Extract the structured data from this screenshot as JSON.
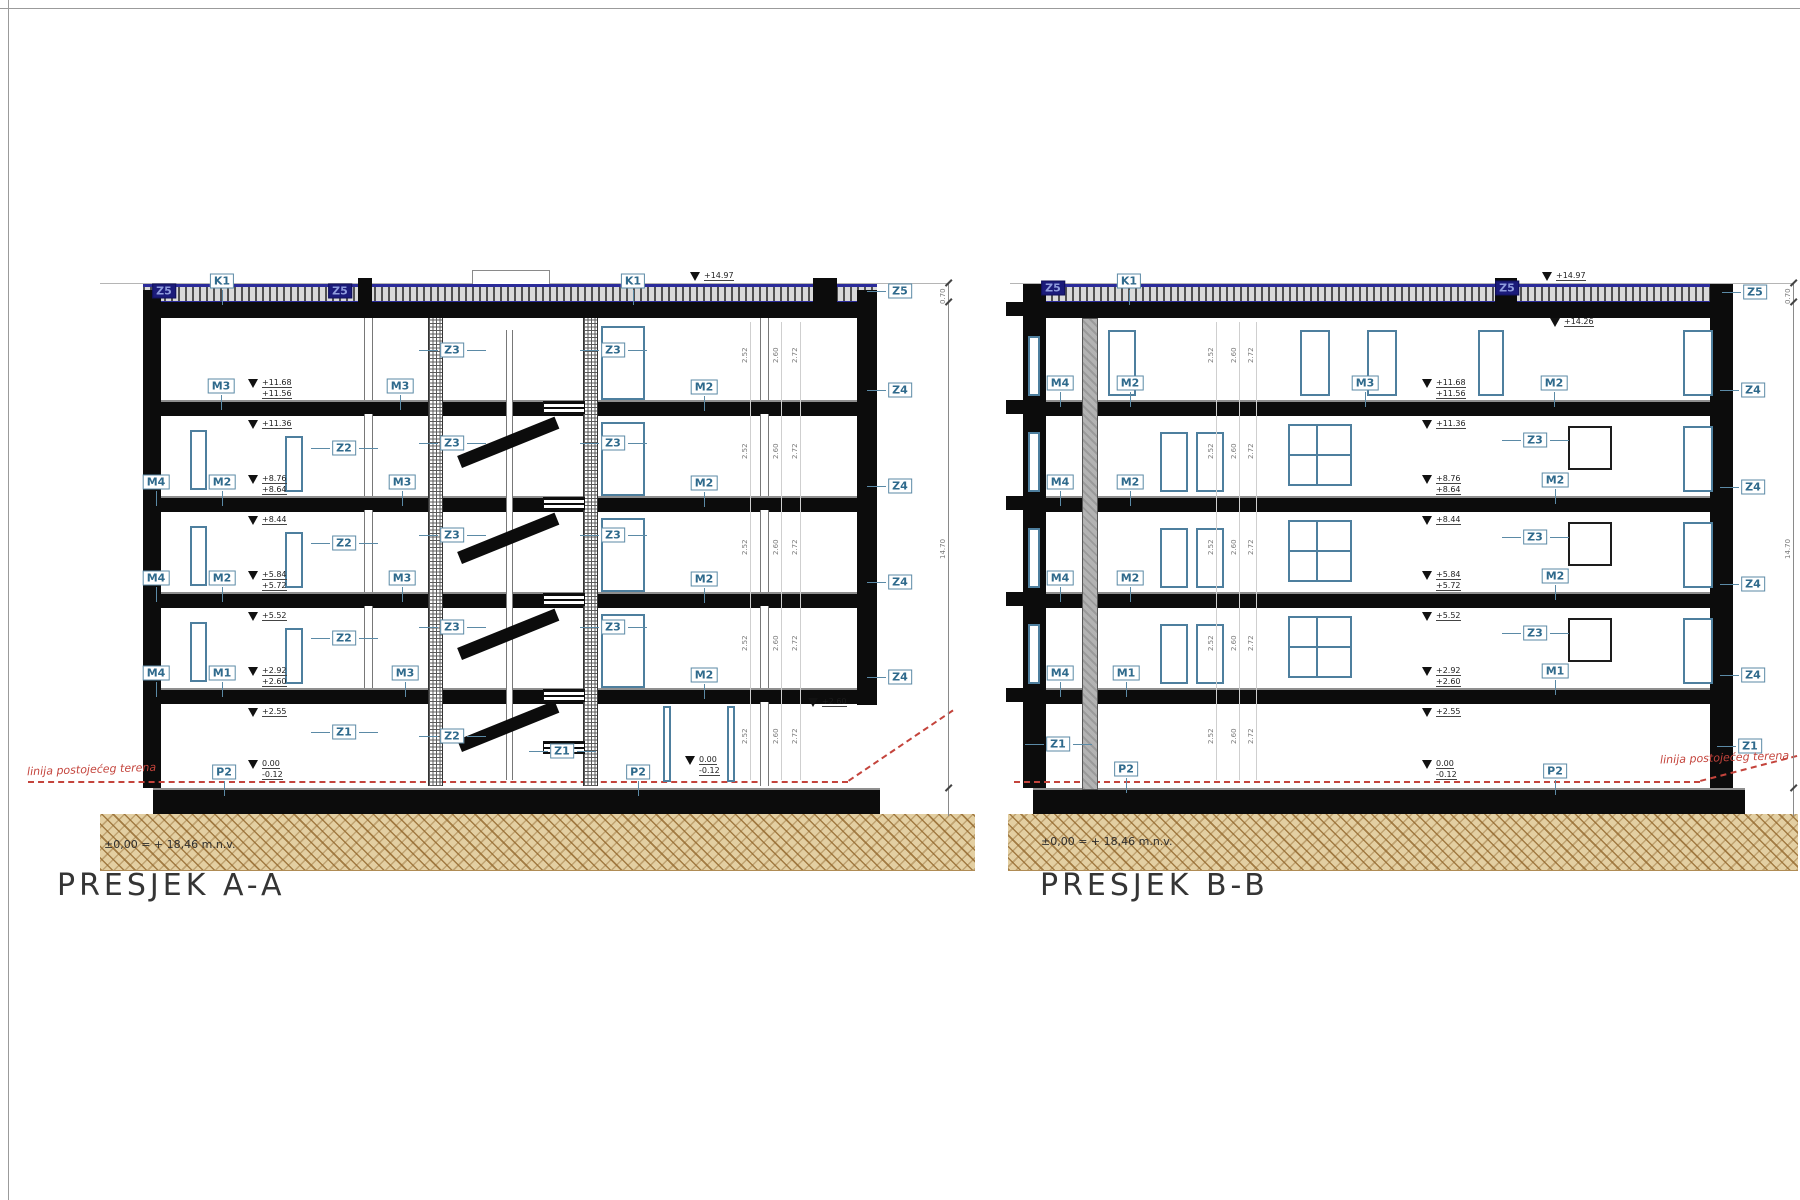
{
  "sheet": {
    "frame_color": "#9b9b9b"
  },
  "colors": {
    "label_blue": "#2f6a8c",
    "label_border": "#5b8aa6",
    "dark_badge": "#1b1b7a",
    "slab_black": "#0c0c0c",
    "window_blue": "#4e7f9e",
    "terrain_red": "#c4443c",
    "ground_tan": "#e3cfa2",
    "ground_line": "#b08c55",
    "roof_blue": "#2b2b9a"
  },
  "sections": [
    {
      "id": "A",
      "title": "PRESJEK A-A",
      "datum_note": "±0,00 = + 18,46 m.n.v.",
      "terrain_label": "linija postojećeg terena",
      "dim_total": "14.70",
      "dim_parapet": "0.70",
      "floor_dims": [
        "2.52",
        "2.60",
        "2.72"
      ],
      "labels": [
        {
          "t": "Z5",
          "x": 164,
          "y": 291,
          "s": "dark"
        },
        {
          "t": "Z5",
          "x": 340,
          "y": 291,
          "s": "dark"
        },
        {
          "t": "K1",
          "x": 222,
          "y": 281,
          "L": "d"
        },
        {
          "t": "K1",
          "x": 633,
          "y": 281,
          "L": "d"
        },
        {
          "t": "Z5",
          "x": 900,
          "y": 291,
          "L": "l"
        },
        {
          "t": "Z4",
          "x": 900,
          "y": 390,
          "L": "l"
        },
        {
          "t": "Z4",
          "x": 900,
          "y": 486,
          "L": "l"
        },
        {
          "t": "Z4",
          "x": 900,
          "y": 582,
          "L": "l"
        },
        {
          "t": "Z4",
          "x": 900,
          "y": 677,
          "L": "l"
        },
        {
          "t": "M3",
          "x": 221,
          "y": 386,
          "L": "d"
        },
        {
          "t": "M3",
          "x": 400,
          "y": 386,
          "L": "d"
        },
        {
          "t": "M2",
          "x": 704,
          "y": 387,
          "L": "d"
        },
        {
          "t": "M4",
          "x": 156,
          "y": 482,
          "L": "d"
        },
        {
          "t": "M2",
          "x": 222,
          "y": 482,
          "L": "d"
        },
        {
          "t": "M3",
          "x": 402,
          "y": 482,
          "L": "d"
        },
        {
          "t": "M2",
          "x": 704,
          "y": 483,
          "L": "d"
        },
        {
          "t": "M4",
          "x": 156,
          "y": 578,
          "L": "d"
        },
        {
          "t": "M2",
          "x": 222,
          "y": 578,
          "L": "d"
        },
        {
          "t": "M3",
          "x": 402,
          "y": 578,
          "L": "d"
        },
        {
          "t": "M2",
          "x": 704,
          "y": 579,
          "L": "d"
        },
        {
          "t": "M4",
          "x": 156,
          "y": 673,
          "L": "d"
        },
        {
          "t": "M1",
          "x": 222,
          "y": 673,
          "L": "d"
        },
        {
          "t": "M3",
          "x": 405,
          "y": 673,
          "L": "d"
        },
        {
          "t": "M2",
          "x": 704,
          "y": 675,
          "L": "d"
        },
        {
          "t": "Z3",
          "x": 452,
          "y": 350,
          "L": "lr"
        },
        {
          "t": "Z3",
          "x": 613,
          "y": 350,
          "L": "lr"
        },
        {
          "t": "Z3",
          "x": 452,
          "y": 443,
          "L": "lr"
        },
        {
          "t": "Z3",
          "x": 613,
          "y": 443,
          "L": "lr"
        },
        {
          "t": "Z3",
          "x": 452,
          "y": 535,
          "L": "lr"
        },
        {
          "t": "Z3",
          "x": 613,
          "y": 535,
          "L": "lr"
        },
        {
          "t": "Z3",
          "x": 452,
          "y": 627,
          "L": "lr"
        },
        {
          "t": "Z3",
          "x": 613,
          "y": 627,
          "L": "lr"
        },
        {
          "t": "Z2",
          "x": 344,
          "y": 448,
          "L": "lr"
        },
        {
          "t": "Z2",
          "x": 344,
          "y": 543,
          "L": "lr"
        },
        {
          "t": "Z2",
          "x": 344,
          "y": 638,
          "L": "lr"
        },
        {
          "t": "Z1",
          "x": 344,
          "y": 732,
          "L": "lr"
        },
        {
          "t": "Z2",
          "x": 452,
          "y": 736,
          "L": "lr"
        },
        {
          "t": "Z1",
          "x": 562,
          "y": 751,
          "L": "lr"
        },
        {
          "t": "P2",
          "x": 224,
          "y": 772,
          "L": "d"
        },
        {
          "t": "P2",
          "x": 638,
          "y": 772,
          "L": "d"
        }
      ],
      "elevations": [
        {
          "x": 700,
          "y": 276,
          "lines": [
            "+14.97"
          ]
        },
        {
          "x": 258,
          "y": 383,
          "lines": [
            "+11.68",
            "+11.56"
          ]
        },
        {
          "x": 258,
          "y": 424,
          "lines": [
            "+11.36"
          ]
        },
        {
          "x": 258,
          "y": 479,
          "lines": [
            "+8.76",
            "+8.64"
          ]
        },
        {
          "x": 258,
          "y": 520,
          "lines": [
            "+8.44"
          ]
        },
        {
          "x": 258,
          "y": 575,
          "lines": [
            "+5.84",
            "+5.72"
          ]
        },
        {
          "x": 258,
          "y": 616,
          "lines": [
            "+5.52"
          ]
        },
        {
          "x": 258,
          "y": 671,
          "lines": [
            "+2.92",
            "+2.60"
          ]
        },
        {
          "x": 258,
          "y": 712,
          "lines": [
            "+2.55"
          ]
        },
        {
          "x": 258,
          "y": 764,
          "lines": [
            "0.00",
            "-0.12"
          ]
        },
        {
          "x": 695,
          "y": 760,
          "lines": [
            "0.00",
            "-0.12"
          ]
        },
        {
          "x": 818,
          "y": 702,
          "lines": [
            "+2.60"
          ]
        }
      ]
    },
    {
      "id": "B",
      "title": "PRESJEK B-B",
      "datum_note": "±0,00 = + 18,46 m.n.v.",
      "terrain_label": "linija postojećeg terena",
      "dim_total": "14.70",
      "dim_parapet": "0.70",
      "floor_dims": [
        "2.52",
        "2.60",
        "2.72"
      ],
      "labels": [
        {
          "t": "Z5",
          "x": 1053,
          "y": 288,
          "s": "dark"
        },
        {
          "t": "Z5",
          "x": 1507,
          "y": 288,
          "s": "dark"
        },
        {
          "t": "K1",
          "x": 1129,
          "y": 281,
          "L": "d"
        },
        {
          "t": "Z5",
          "x": 1755,
          "y": 292,
          "L": "l"
        },
        {
          "t": "Z4",
          "x": 1753,
          "y": 390,
          "L": "l"
        },
        {
          "t": "Z4",
          "x": 1753,
          "y": 487,
          "L": "l"
        },
        {
          "t": "Z4",
          "x": 1753,
          "y": 584,
          "L": "l"
        },
        {
          "t": "Z4",
          "x": 1753,
          "y": 675,
          "L": "l"
        },
        {
          "t": "Z1",
          "x": 1750,
          "y": 746,
          "L": "l"
        },
        {
          "t": "M4",
          "x": 1060,
          "y": 383,
          "L": "d"
        },
        {
          "t": "M2",
          "x": 1130,
          "y": 383,
          "L": "d"
        },
        {
          "t": "M3",
          "x": 1365,
          "y": 383,
          "L": "d"
        },
        {
          "t": "M2",
          "x": 1554,
          "y": 383,
          "L": "d"
        },
        {
          "t": "M4",
          "x": 1060,
          "y": 482,
          "L": "d"
        },
        {
          "t": "M2",
          "x": 1130,
          "y": 482,
          "L": "d"
        },
        {
          "t": "M2",
          "x": 1555,
          "y": 480,
          "L": "d"
        },
        {
          "t": "M4",
          "x": 1060,
          "y": 578,
          "L": "d"
        },
        {
          "t": "M2",
          "x": 1130,
          "y": 578,
          "L": "d"
        },
        {
          "t": "M2",
          "x": 1555,
          "y": 576,
          "L": "d"
        },
        {
          "t": "M4",
          "x": 1060,
          "y": 673,
          "L": "d"
        },
        {
          "t": "M1",
          "x": 1126,
          "y": 673,
          "L": "d"
        },
        {
          "t": "M1",
          "x": 1555,
          "y": 671,
          "L": "d"
        },
        {
          "t": "Z3",
          "x": 1535,
          "y": 440,
          "L": "lr"
        },
        {
          "t": "Z3",
          "x": 1535,
          "y": 537,
          "L": "lr"
        },
        {
          "t": "Z3",
          "x": 1535,
          "y": 633,
          "L": "lr"
        },
        {
          "t": "Z1",
          "x": 1058,
          "y": 744,
          "L": "lr"
        },
        {
          "t": "P2",
          "x": 1126,
          "y": 769,
          "L": "d"
        },
        {
          "t": "P2",
          "x": 1555,
          "y": 771,
          "L": "d"
        }
      ],
      "elevations": [
        {
          "x": 1552,
          "y": 276,
          "lines": [
            "+14.97"
          ]
        },
        {
          "x": 1560,
          "y": 322,
          "lines": [
            "+14.26"
          ]
        },
        {
          "x": 1432,
          "y": 383,
          "lines": [
            "+11.68",
            "+11.56"
          ]
        },
        {
          "x": 1432,
          "y": 424,
          "lines": [
            "+11.36"
          ]
        },
        {
          "x": 1432,
          "y": 479,
          "lines": [
            "+8.76",
            "+8.64"
          ]
        },
        {
          "x": 1432,
          "y": 520,
          "lines": [
            "+8.44"
          ]
        },
        {
          "x": 1432,
          "y": 575,
          "lines": [
            "+5.84",
            "+5.72"
          ]
        },
        {
          "x": 1432,
          "y": 616,
          "lines": [
            "+5.52"
          ]
        },
        {
          "x": 1432,
          "y": 671,
          "lines": [
            "+2.92",
            "+2.60"
          ]
        },
        {
          "x": 1432,
          "y": 712,
          "lines": [
            "+2.55"
          ]
        },
        {
          "x": 1432,
          "y": 764,
          "lines": [
            "0.00",
            "-0.12"
          ]
        }
      ]
    }
  ]
}
